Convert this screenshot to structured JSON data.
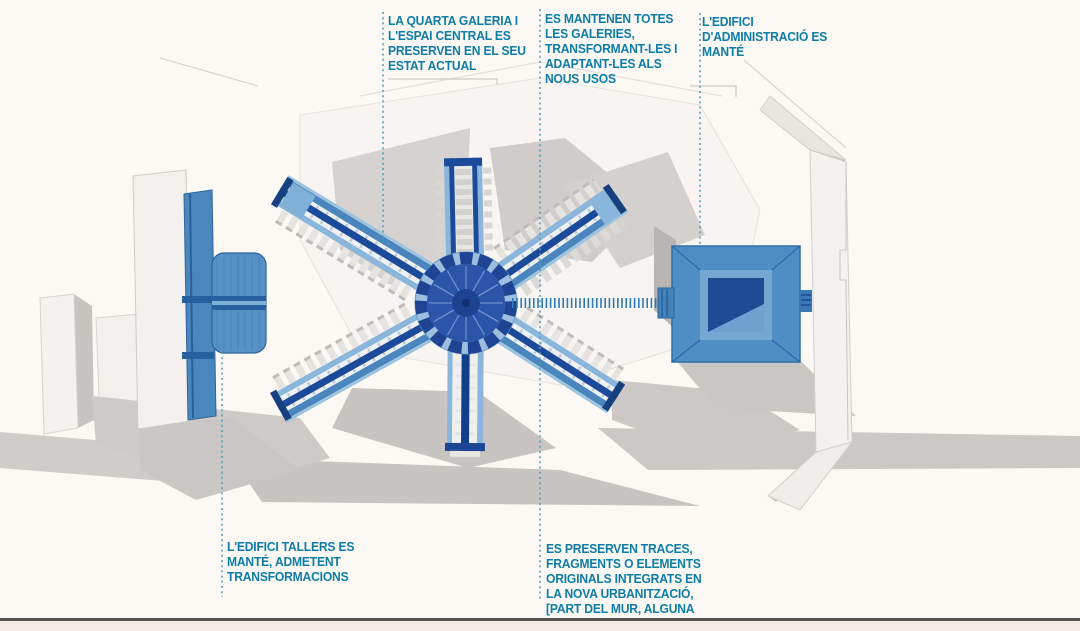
{
  "annotations": {
    "top_left": "LA QUARTA GALERIA I\nL'ESPAI CENTRAL ES\nPRESERVEN EN EL SEU\nESTAT ACTUAL",
    "top_middle": "ES MANTENEN TOTES\nLES GALERIES,\nTRANSFORMANT-LES I\nADAPTANT-LES ALS\nNOUS USOS",
    "top_right": "L'EDIFICI\nD'ADMINISTRACIÓ ES\nMANTÉ",
    "bottom_left": "L'EDIFICI TALLERS ES\nMANTÉ, ADMETENT\nTRANSFORMACIONS",
    "bottom_middle": "ES PRESERVEN TRACES,\nFRAGMENTS O ELEMENTS\nORIGINALS INTEGRATS EN\nLA NOVA URBANITZACIÓ,\n[PART DEL MUR, ALGUNA"
  },
  "colors": {
    "annotation_text": "#0d7da8",
    "leader_dotted": "#4a9cba",
    "background": "#fcf8f3",
    "gallery_blue": "#4a86bd",
    "dark_blue_spine": "#1c4a9a",
    "light_blue": "#8ab6dc",
    "hub_dark": "#1f4494",
    "shadow_grey": "#c7c4c1",
    "building_white": "#f3f0ed",
    "bottom_rule": "#55514e"
  }
}
